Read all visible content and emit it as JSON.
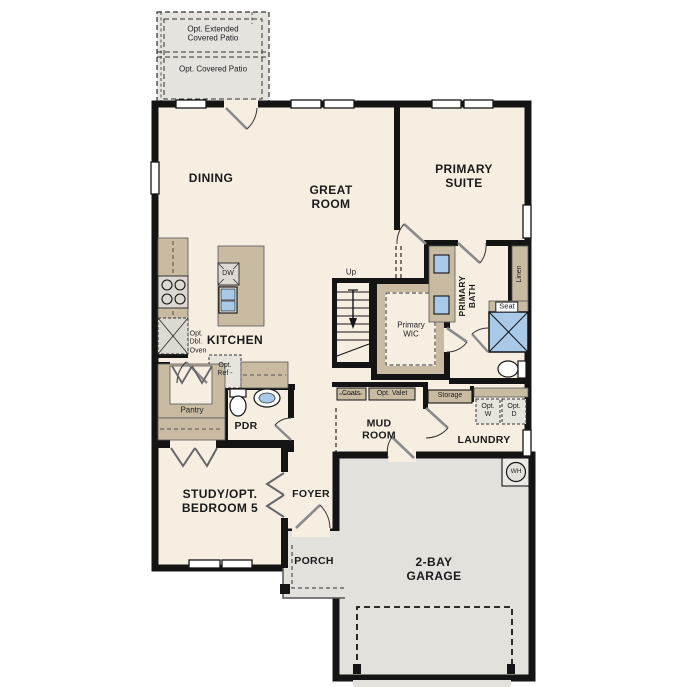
{
  "plan_title": "Single-story floor plan",
  "colors": {
    "floor": "#f6eee1",
    "wall": "#141414",
    "cabinet": "#c9bba1",
    "concrete": "#e2e1dc",
    "fixture_blue": "#a9c9e8"
  },
  "labels": {
    "patio_extended": [
      "Opt. Extended",
      "Covered Patio"
    ],
    "patio_covered": "Opt. Covered Patio",
    "dining": "DINING",
    "great_room": [
      "GREAT",
      "ROOM"
    ],
    "primary_suite": [
      "PRIMARY",
      "SUITE"
    ],
    "kitchen": "KITCHEN",
    "dw": "DW",
    "opt_dbl_oven": [
      "Opt.",
      "Dbl.",
      "Oven"
    ],
    "opt_ref": [
      "Opt.",
      "Ref -"
    ],
    "pantry": "Pantry",
    "pdr": "PDR",
    "up": "Up",
    "primary_wic": [
      "Primary",
      "WIC"
    ],
    "primary_bath": [
      "PRIMARY",
      "BATH"
    ],
    "linen": "Linen",
    "seat": "Seat",
    "coats": "Coats",
    "opt_valet": "Opt. Valet",
    "storage": "Storage",
    "opt_w": [
      "Opt.",
      "W"
    ],
    "opt_d": [
      "Opt.",
      "D"
    ],
    "mud_room": [
      "MUD",
      "ROOM"
    ],
    "laundry": "LAUNDRY",
    "study": [
      "STUDY/OPT.",
      "BEDROOM 5"
    ],
    "foyer": "FOYER",
    "porch": "PORCH",
    "garage": [
      "2-BAY",
      "GARAGE"
    ],
    "water_heater": "WH"
  }
}
